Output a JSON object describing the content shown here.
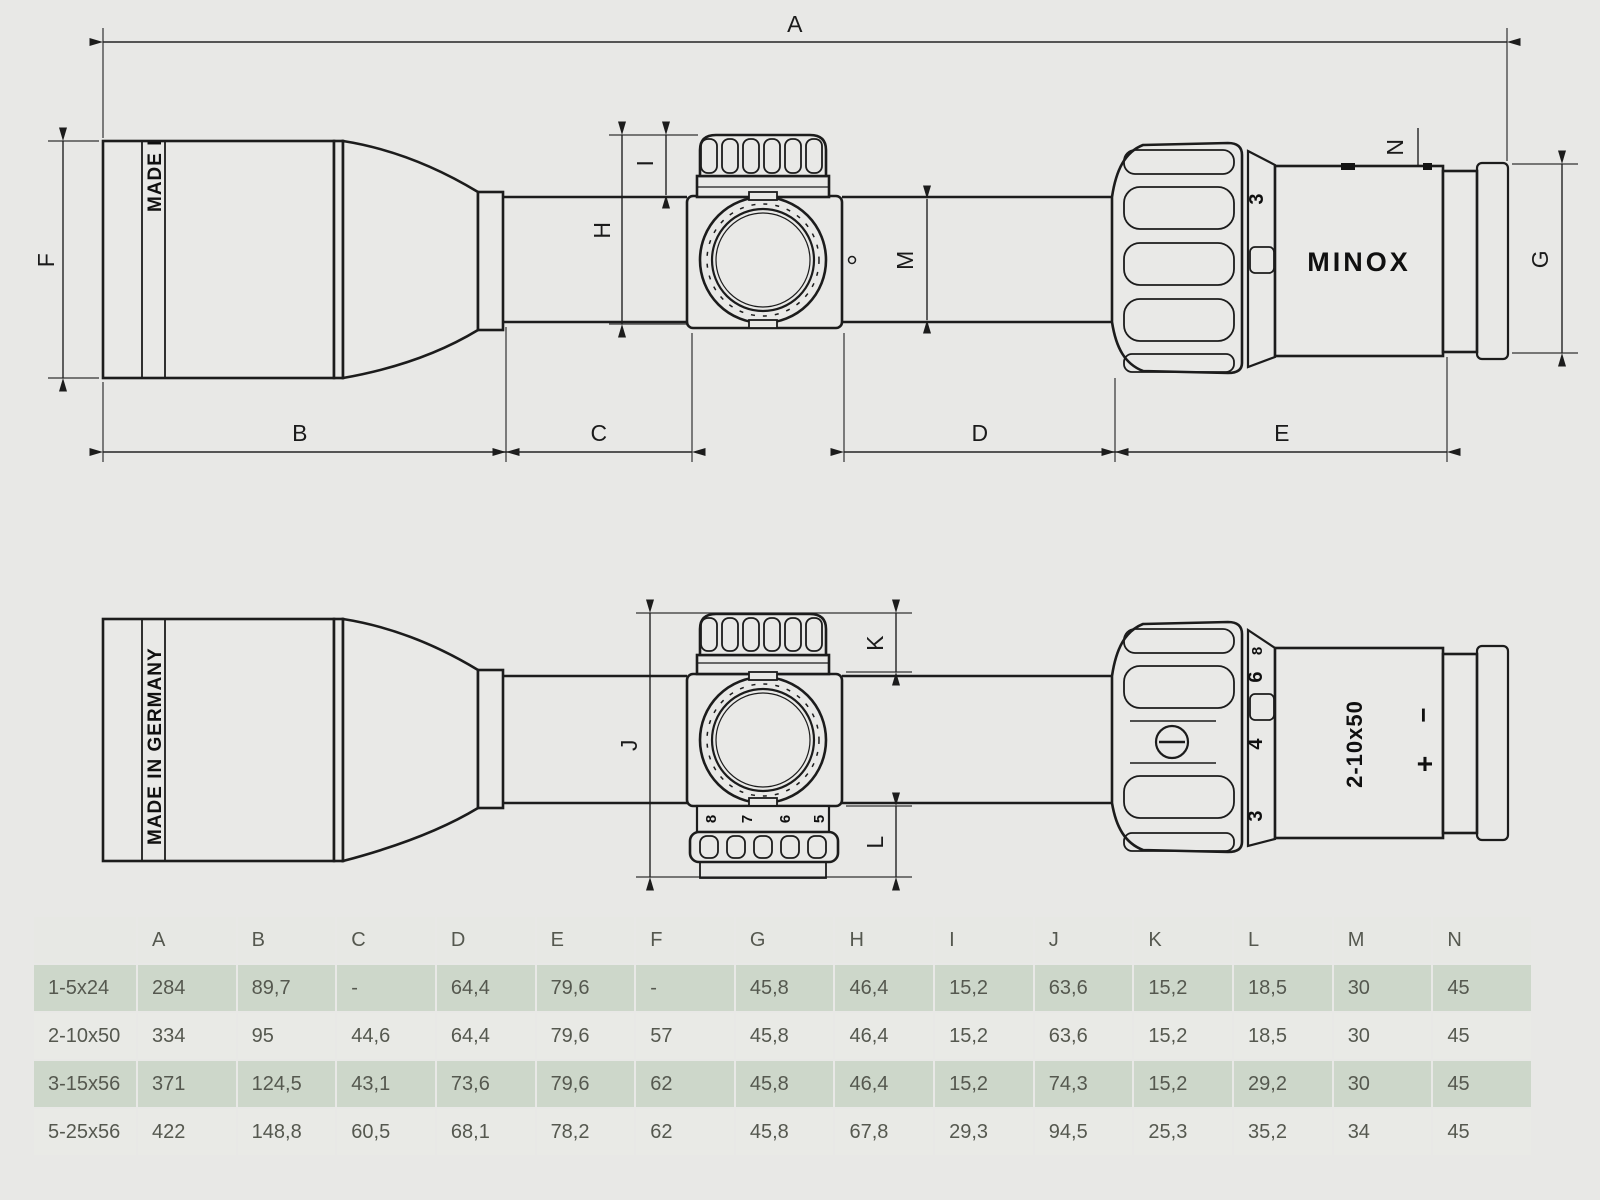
{
  "colors": {
    "background": "#e8e8e6",
    "line": "#1c1c1c",
    "table_row_green": "#cdd7ca",
    "table_row_light": "#e9eae6",
    "table_header_bg": "#e7e8e4",
    "table_text": "#55584f"
  },
  "drawing": {
    "brand_logo": "MINOX",
    "made_in_full": "MADE IN GERMANY",
    "made_in_partial": "MADE I",
    "model_marking": "2-10x50",
    "plus_marking": "+",
    "minus_marking": "−",
    "dims": {
      "A": "A",
      "B": "B",
      "C": "C",
      "D": "D",
      "E": "E",
      "F": "F",
      "G": "G",
      "H": "H",
      "I": "I",
      "J": "J",
      "K": "K",
      "L": "L",
      "M": "M",
      "N": "N"
    },
    "mag_ring_top_marks": {
      "m3": "3"
    },
    "mag_ring_bottom_marks": {
      "m8": "8",
      "m6": "6",
      "m4": "4",
      "m3": "3"
    },
    "turret_scale_numbers": {
      "t8": "8",
      "t7": "7",
      "t6": "6",
      "t5": "5"
    }
  },
  "table": {
    "headers": [
      "",
      "A",
      "B",
      "C",
      "D",
      "E",
      "F",
      "G",
      "H",
      "I",
      "J",
      "K",
      "L",
      "M",
      "N"
    ],
    "rows": [
      {
        "model": "1-5x24",
        "values": [
          "284",
          "89,7",
          "-",
          "64,4",
          "79,6",
          "-",
          "45,8",
          "46,4",
          "15,2",
          "63,6",
          "15,2",
          "18,5",
          "30",
          "45"
        ]
      },
      {
        "model": "2-10x50",
        "values": [
          "334",
          "95",
          "44,6",
          "64,4",
          "79,6",
          "57",
          "45,8",
          "46,4",
          "15,2",
          "63,6",
          "15,2",
          "18,5",
          "30",
          "45"
        ]
      },
      {
        "model": "3-15x56",
        "values": [
          "371",
          "124,5",
          "43,1",
          "73,6",
          "79,6",
          "62",
          "45,8",
          "46,4",
          "15,2",
          "74,3",
          "15,2",
          "29,2",
          "30",
          "45"
        ]
      },
      {
        "model": "5-25x56",
        "values": [
          "422",
          "148,8",
          "60,5",
          "68,1",
          "78,2",
          "62",
          "45,8",
          "67,8",
          "29,3",
          "94,5",
          "25,3",
          "35,2",
          "34",
          "45"
        ]
      }
    ]
  }
}
